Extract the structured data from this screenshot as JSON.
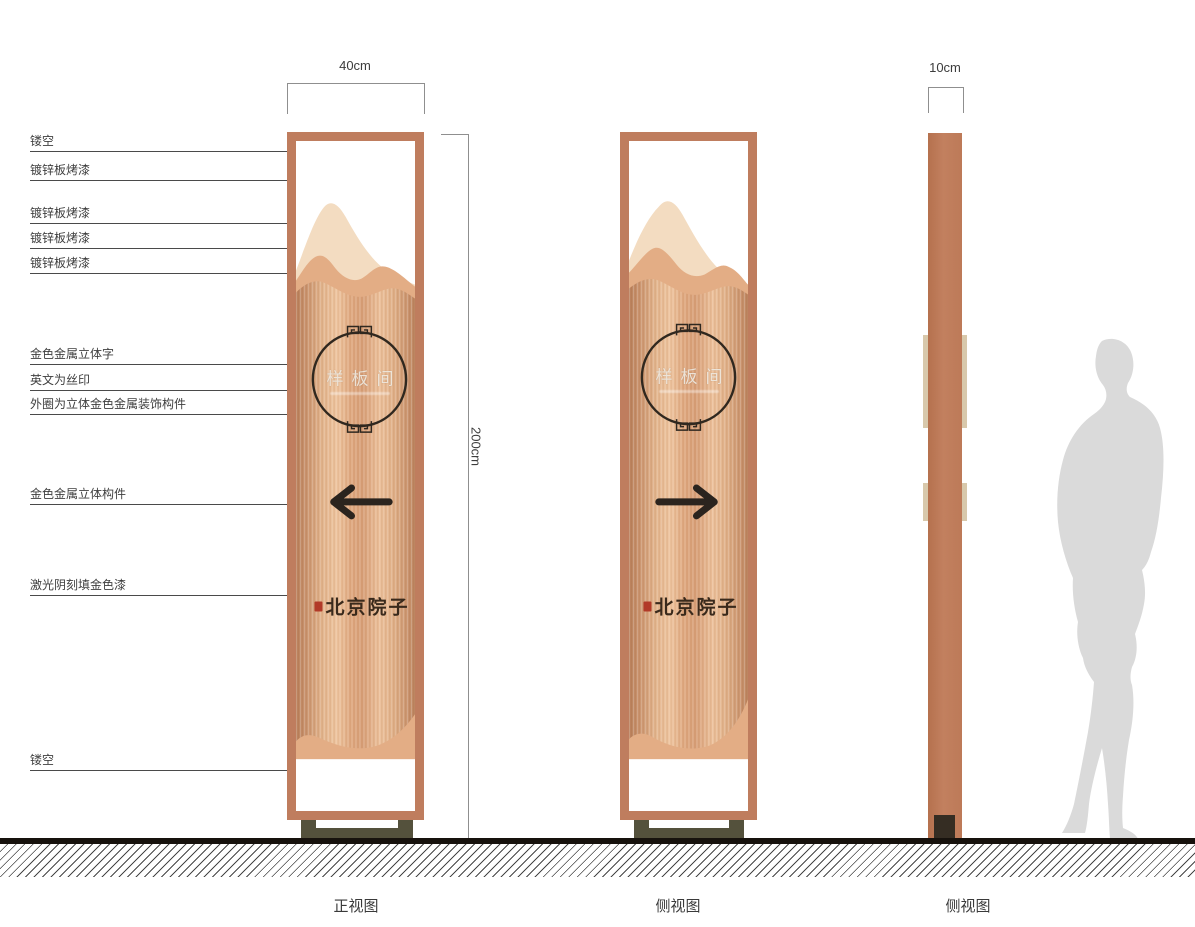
{
  "annotations": {
    "callouts_left": [
      {
        "label": "镂空"
      },
      {
        "label": "镀锌板烤漆"
      },
      {
        "label": "镀锌板烤漆"
      },
      {
        "label": "镀锌板烤漆"
      },
      {
        "label": "镀锌板烤漆"
      },
      {
        "label": "金色金属立体字"
      },
      {
        "label": "英文为丝印"
      },
      {
        "label": "外圈为立体金色金属装饰构件"
      },
      {
        "label": "金色金属立体构件"
      },
      {
        "label": "激光阴刻填金色漆"
      },
      {
        "label": "镂空"
      }
    ],
    "dimensions": {
      "front_width": "40cm",
      "height": "200cm",
      "side_depth": "10cm"
    }
  },
  "panels": {
    "front": {
      "view_label": "正视图",
      "circle_text": "样板间",
      "brand_text": "北京院子",
      "arrow": "left"
    },
    "back": {
      "view_label": "侧视图",
      "circle_text": "样板间",
      "brand_text": "北京院子",
      "arrow": "right"
    },
    "side": {
      "view_label": "侧视图"
    }
  },
  "colors": {
    "frame_copper": "#bf7d5e",
    "body_light": "#eec29e",
    "body_dark": "#bd8560",
    "mountain_back": "#f3dcc1",
    "mountain_mid": "#e3ad85",
    "base_olive": "#54513c",
    "seal_red": "#b23a28",
    "silhouette_gray": "#dadada",
    "ink_dark": "#2b241e"
  }
}
